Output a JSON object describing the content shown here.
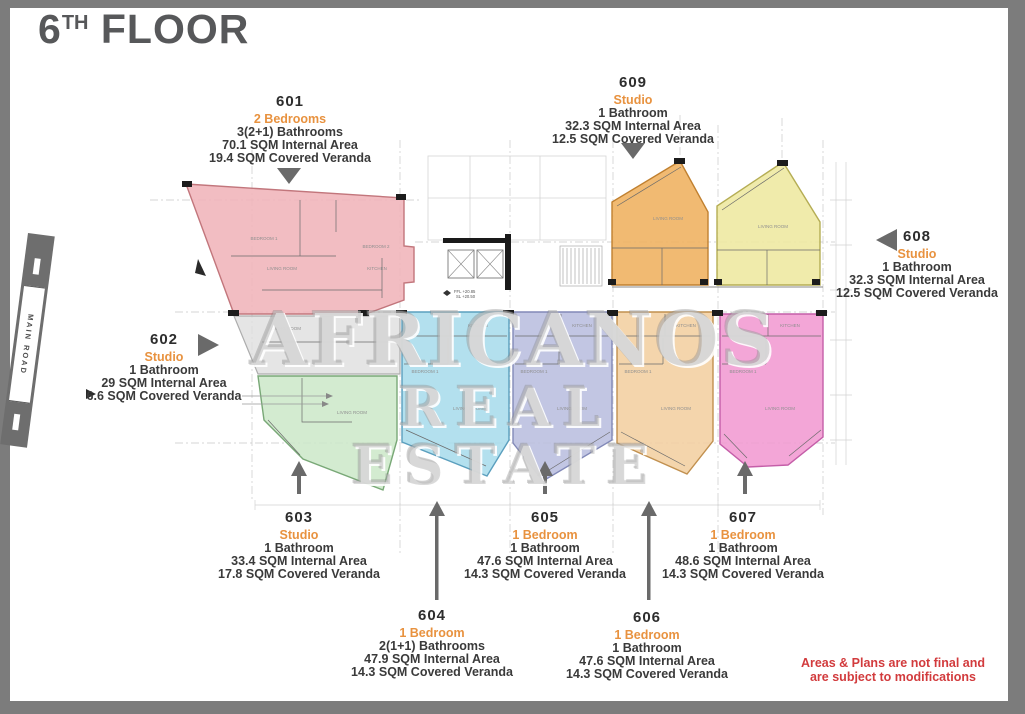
{
  "title": {
    "number": "6",
    "suffix": "TH",
    "word": "FLOOR"
  },
  "road_label": "MAIN ROAD",
  "watermark": {
    "line1": "AFRICANOS",
    "line2": "REAL ESTATE"
  },
  "disclaimer": {
    "line1": "Areas & Plans are not final and",
    "line2": "are subject to modifications"
  },
  "units": {
    "601": {
      "number": "601",
      "type": "2 Bedrooms",
      "bath": "3(2+1) Bathrooms",
      "internal": "70.1 SQM Internal Area",
      "veranda": "19.4 SQM Covered Veranda",
      "color": "#f0b4b9"
    },
    "602": {
      "number": "602",
      "type": "Studio",
      "bath": "1 Bathroom",
      "internal": "29 SQM Internal Area",
      "veranda": "6.6 SQM Covered Veranda",
      "color": "#dedede"
    },
    "603": {
      "number": "603",
      "type": "Studio",
      "bath": "1 Bathroom",
      "internal": "33.4 SQM Internal Area",
      "veranda": "17.8 SQM Covered Veranda",
      "color": "#cde8c9"
    },
    "604": {
      "number": "604",
      "type": "1 Bedroom",
      "bath": "2(1+1) Bathrooms",
      "internal": "47.9 SQM Internal Area",
      "veranda": "14.3 SQM Covered Veranda",
      "color": "#a8dcec"
    },
    "605": {
      "number": "605",
      "type": "1 Bedroom",
      "bath": "1 Bathroom",
      "internal": "47.6 SQM Internal Area",
      "veranda": "14.3 SQM Covered Veranda",
      "color": "#b9bedf"
    },
    "606": {
      "number": "606",
      "type": "1 Bedroom",
      "bath": "1 Bathroom",
      "internal": "47.6 SQM Internal Area",
      "veranda": "14.3 SQM Covered Veranda",
      "color": "#f2cfa0"
    },
    "607": {
      "number": "607",
      "type": "1 Bedroom",
      "bath": "1 Bathroom",
      "internal": "48.6 SQM Internal Area",
      "veranda": "14.3 SQM Covered Veranda",
      "color": "#f19ad2"
    },
    "608": {
      "number": "608",
      "type": "Studio",
      "bath": "1 Bathroom",
      "internal": "32.3 SQM Internal Area",
      "veranda": "12.5 SQM Covered Veranda",
      "color": "#eee9a2"
    },
    "609": {
      "number": "609",
      "type": "Studio",
      "bath": "1 Bathroom",
      "internal": "32.3 SQM Internal Area",
      "veranda": "12.5 SQM Covered Veranda",
      "color": "#efb263"
    }
  },
  "plan": {
    "level_marks": {
      "line1": "FFL +20.85",
      "line2": "SL +20.50"
    },
    "room_labels": [
      "BEDROOM 1",
      "BEDROOM 2",
      "LIVING ROOM",
      "KITCHEN",
      "LIVING ROOM",
      "LIVING ROOM",
      "KITCHEN",
      "BEDROOM 1",
      "LIVING ROOM",
      "KITCHEN",
      "BEDROOM 1",
      "LIVING ROOM",
      "KITCHEN",
      "BEDROOM 1",
      "LIVING ROOM",
      "KITCHEN",
      "BEDROOM 1",
      "LIVING ROOM",
      "LIVING ROOM",
      "LIVING ROOM"
    ],
    "accent_colors": {
      "label_orange": "#e8923f",
      "text_dark": "#3a3a3a",
      "arrow_gray": "#6a6a6a",
      "disclaimer_red": "#d23b3d",
      "title_gray": "#57585a",
      "border_gray": "#7c7c7c"
    }
  }
}
